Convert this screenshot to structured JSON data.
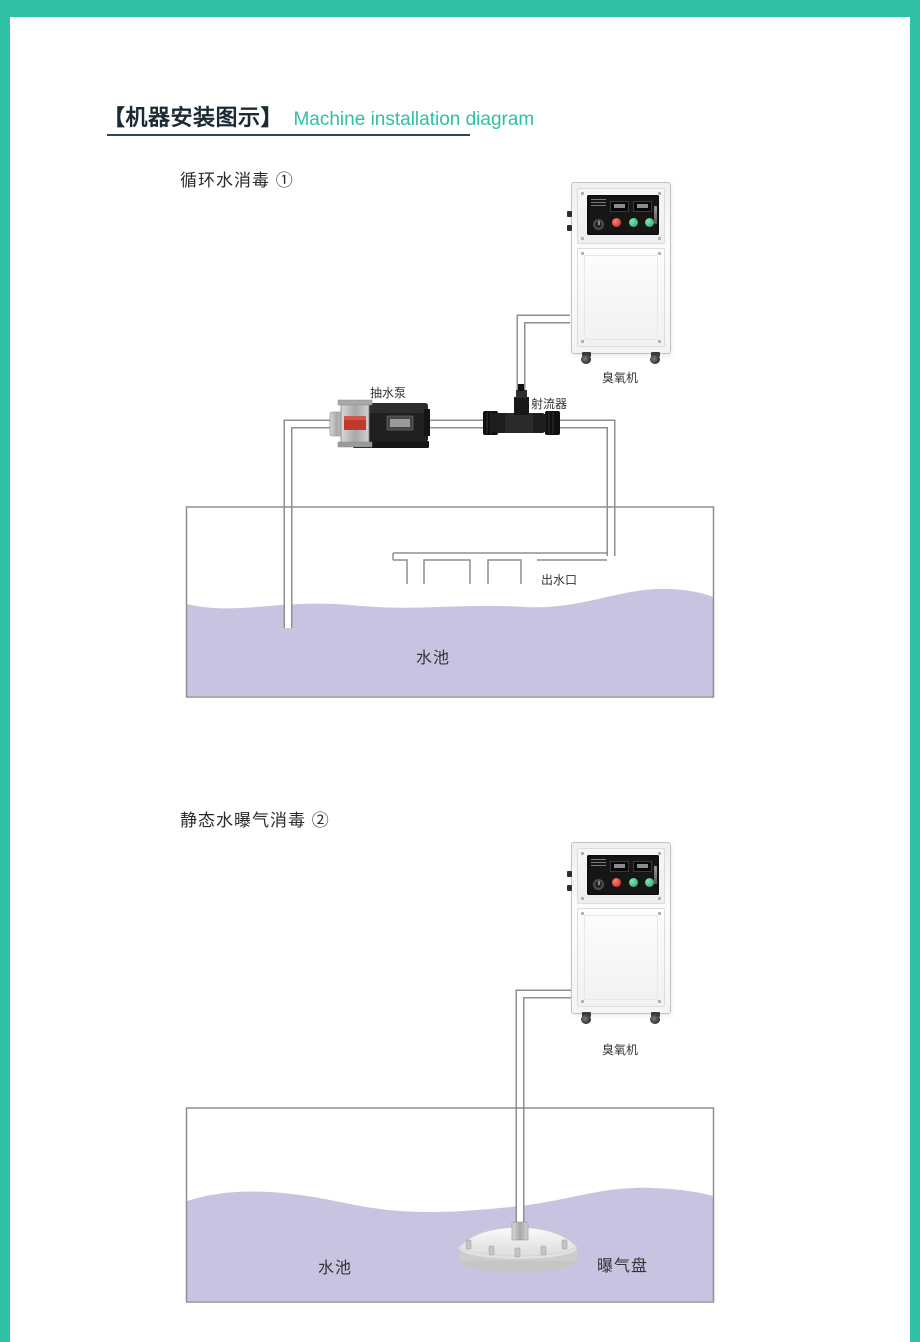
{
  "header": {
    "title_zh": "【机器安装图示】",
    "title_en": "Machine installation diagram"
  },
  "diagram1": {
    "title": "循环水消毒 ①",
    "pump_label": "抽水泵",
    "ejector_label": "射流器",
    "machine_label": "臭氧机",
    "outlet_label": "出水口",
    "pool_label": "水池"
  },
  "diagram2": {
    "title": "静态水曝气消毒 ②",
    "machine_label": "臭氧机",
    "pool_label": "水池",
    "disc_label": "曝气盘"
  },
  "colors": {
    "accent_teal": "#2ec1a5",
    "title_en_teal": "#2fbfa5",
    "title_dark": "#1c2b33",
    "underline": "#264a52",
    "water_lavender": "#c8c3e0",
    "pipe_edge_gray": "#8f8f8f",
    "panel_black": "#161616",
    "button_red": "#c22619",
    "button_green": "#1fa05f"
  }
}
